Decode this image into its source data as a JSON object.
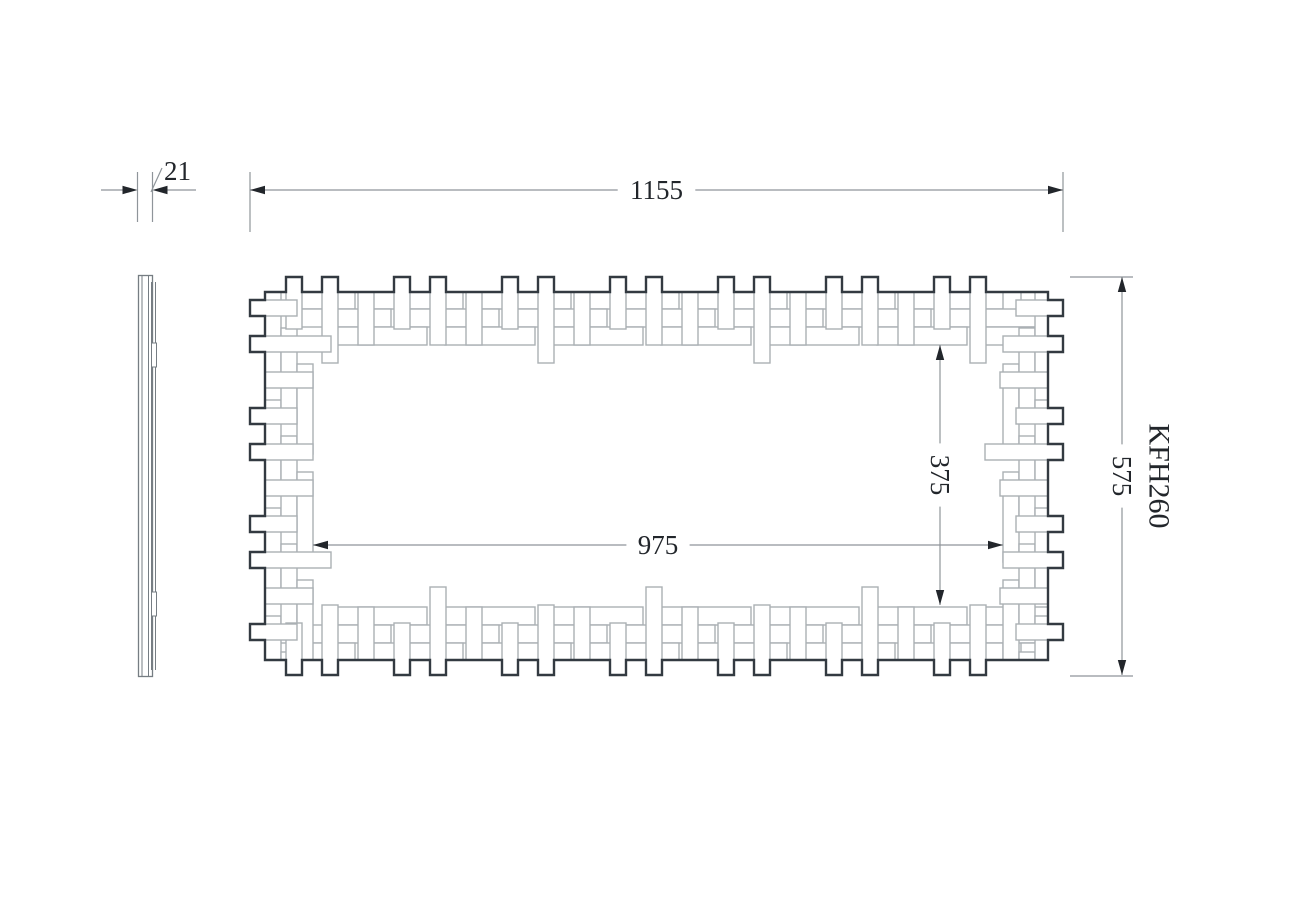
{
  "drawing": {
    "title": "mirror-frame-technical-drawing",
    "labels": {
      "thickness": "21",
      "overall_width": "1155",
      "overall_height": "575",
      "opening_width": "975",
      "opening_height": "375",
      "model": "KFH260"
    },
    "colors": {
      "background": "#ffffff",
      "outline": "#333a41",
      "weave": "#aab0b4",
      "side": "#767d83",
      "dimension": "#8f959a",
      "text": "#22262b"
    }
  }
}
